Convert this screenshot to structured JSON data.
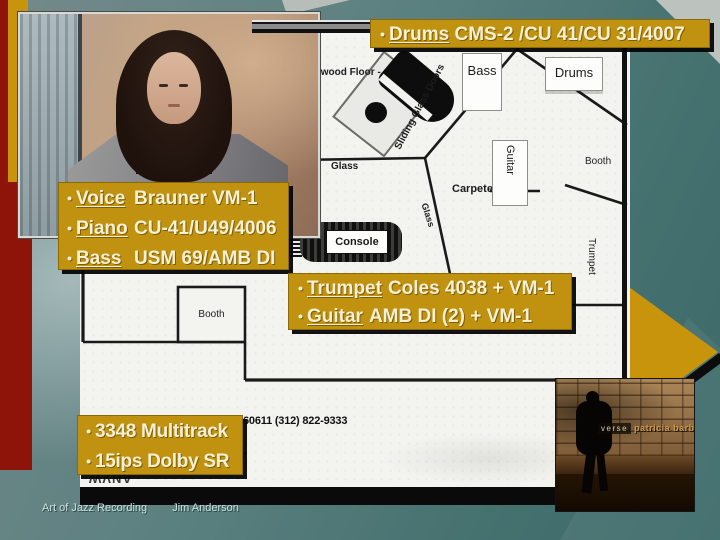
{
  "bullet": "•",
  "callout_drums": {
    "term": "Drums",
    "desc": "CMS-2 /CU 41/CU 31/4007"
  },
  "callout_sources": {
    "items": [
      {
        "term": "Voice",
        "desc": "Brauner VM-1"
      },
      {
        "term": "Piano",
        "desc": "CU-41/U49/4006"
      },
      {
        "term": "Bass",
        "desc": "USM 69/AMB DI"
      }
    ]
  },
  "callout_overdubs": {
    "items": [
      {
        "term": "Trumpet",
        "desc": "Coles 4038 + VM-1"
      },
      {
        "term": "Guitar",
        "desc": "AMB DI (2) + VM-1"
      }
    ]
  },
  "callout_tape": {
    "items": [
      "3348 Multitrack",
      "15ips Dolby SR"
    ]
  },
  "floorplan": {
    "hardwood_label": "Hardwood Floor -",
    "sliding_label": "Sliding Glass Doors",
    "bass_label": "Bass",
    "drums_label": "Drums",
    "glass_top_label": "Glass",
    "glass_side_label": "Glass",
    "guitar_label": "Guitar",
    "carpeted_label": "Carpeted",
    "console_label": "Console",
    "trumpet_label": "Trumpet",
    "booth_right_label": "Booth",
    "booth_left_label": "Booth",
    "phone_text": "60611 (312) 822-9333",
    "dimension_text": "28'",
    "stamp_text": "ANVW"
  },
  "album": {
    "title": "verse",
    "artist": "patricia barber"
  },
  "footer": {
    "course": "Art of Jazz Recording",
    "author": "Jim Anderson"
  },
  "colors": {
    "gold": "#c1920f",
    "maroon": "#8e1309",
    "teal": "#4b7878",
    "cream": "#f6f0d4"
  }
}
